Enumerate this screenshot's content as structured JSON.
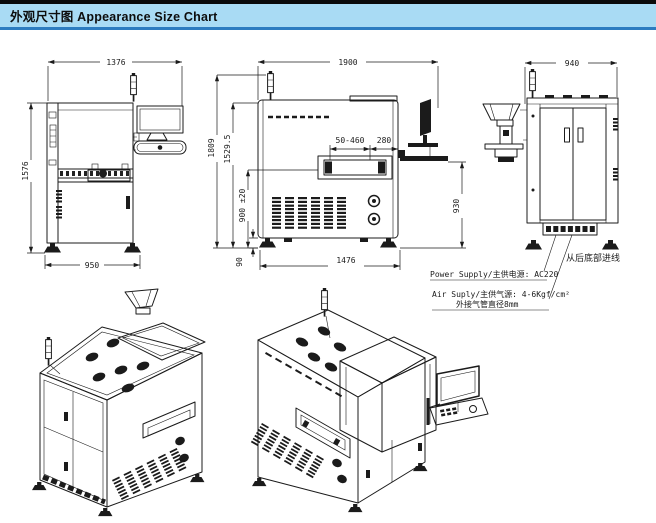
{
  "header": {
    "title": "外观尺寸图 Appearance Size Chart",
    "band_color": "#a9dbf4",
    "rule_color": "#2d7cc0",
    "top_bar_color": "#0a0a0a"
  },
  "drawing": {
    "line_color": "#1b1b1b",
    "background": "#ffffff"
  },
  "views": {
    "side_left": {
      "dim_top_width": "1376",
      "dim_total_height": "1576",
      "dim_base_width": "950"
    },
    "front": {
      "dim_top_width": "1900",
      "dim_total_height": "1809",
      "dim_body_height": "1529.5",
      "dim_conveyor_height": "900 ±20",
      "dim_foot_height": "90",
      "dim_base_width": "1476",
      "dim_pcb_range": "50-460",
      "dim_edge_offset": "280",
      "dim_keyboard_height": "930"
    },
    "side_right": {
      "dim_top_width": "940",
      "note_cable_entry": "从后底部进线",
      "note_power": "Power Supply/主供电源: AC220",
      "note_air_line1": "Air Suply/主供气源: 4-6Kgf/cm²",
      "note_air_line2": "外接气管直径8mm"
    }
  }
}
